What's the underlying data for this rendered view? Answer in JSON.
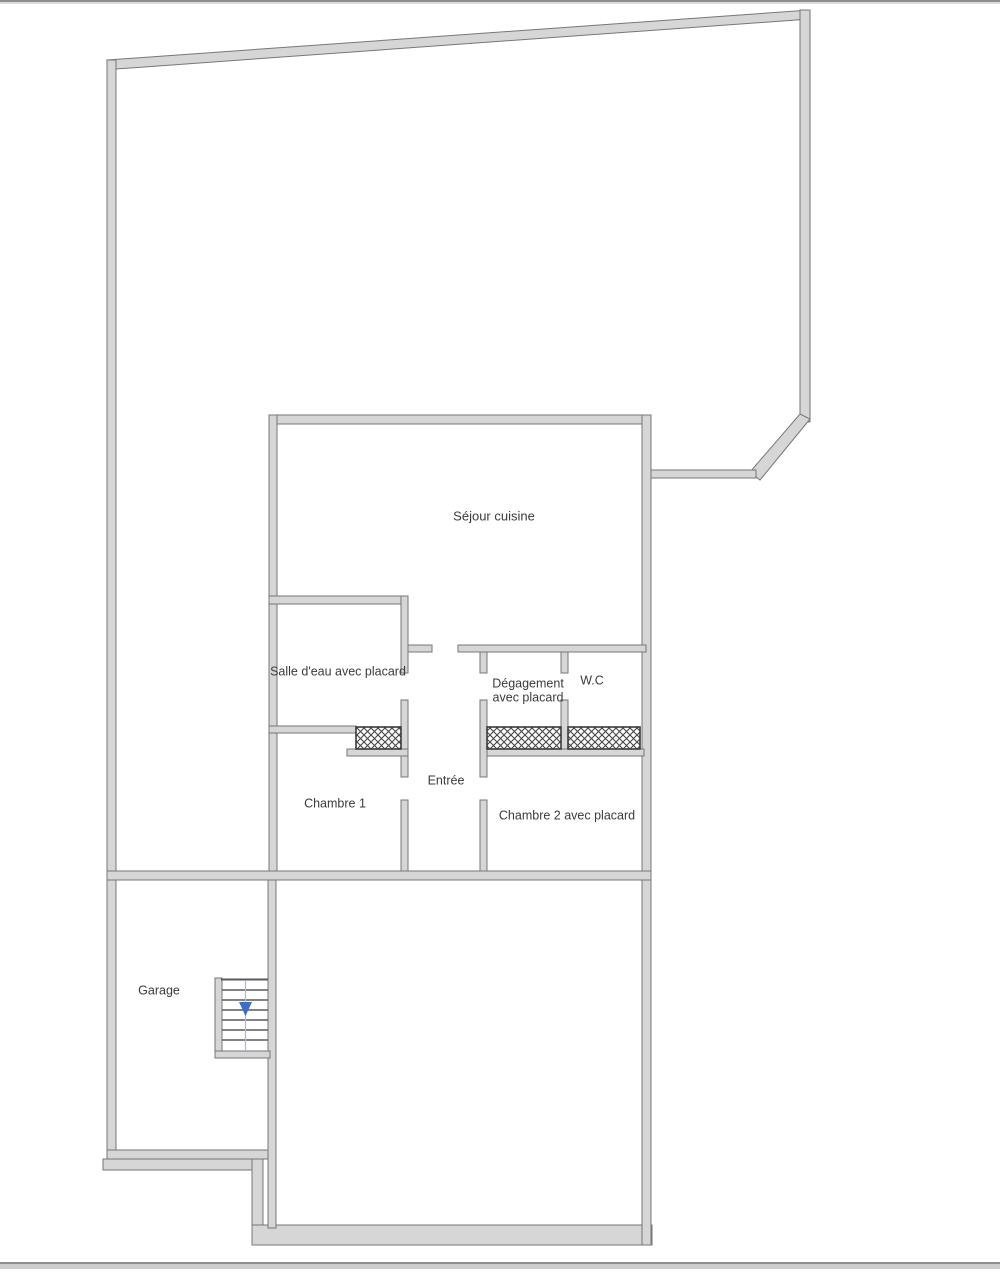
{
  "labels": {
    "sejour_cuisine": "Séjour cuisine",
    "salle_eau": "Salle d'eau avec placard",
    "degagement_line1": "Dégagement",
    "degagement_line2": "avec placard",
    "wc": "W.C",
    "entree": "Entrée",
    "chambre1": "Chambre 1",
    "chambre2": "Chambre 2 avec placard",
    "garage": "Garage"
  },
  "colors": {
    "wall_fill": "#d6d6d6",
    "wall_edge": "#777777",
    "hatch_line": "#454545",
    "stair_arrow": "#3f6cc8",
    "stair_guide": "#a4bde4",
    "text": "#3b3b3b",
    "frame_line": "#8e8e8e"
  }
}
